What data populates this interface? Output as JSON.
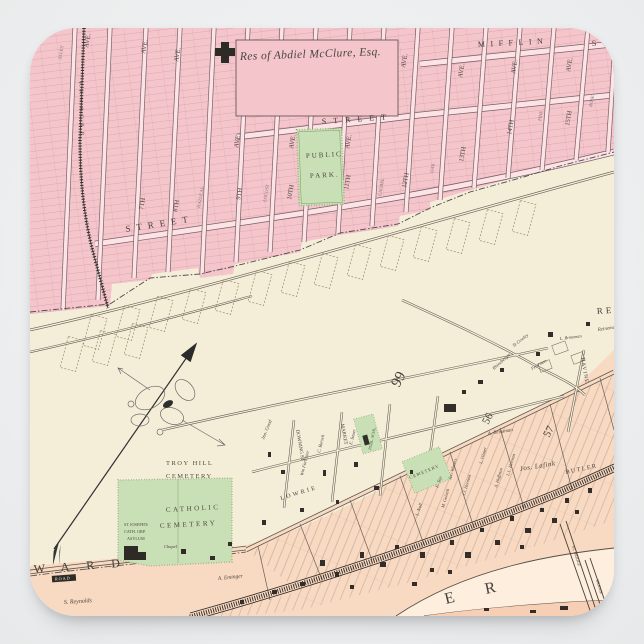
{
  "colors": {
    "page_bg": "#edeff0",
    "pink": "#f4c6cc",
    "pink_street": "#fbe3e6",
    "cream": "#f4eed9",
    "peach": "#f8d9c2",
    "peach_deep": "#f6cfb4",
    "river": "#fdeede",
    "green": "#c9dfb5",
    "green_edge": "#85a06b",
    "ink": "#3f3b38"
  },
  "labels": {
    "estate": "Res of Abdiel McClure, Esq.",
    "mifflin": "MIFFLIN",
    "mifflin_s": "S",
    "street_upper": "STREET",
    "street_lower": "STREET",
    "ward": "WARD",
    "road": "ROAD",
    "river_e": "E",
    "river_r": "R",
    "lowrie": "LOWRIE",
    "butler": "BUTLER",
    "ravine": "RAVINE",
    "downing": "DOWNING ST",
    "market": "MARKET",
    "re": "RE",
    "num99": "99",
    "num56": "56",
    "num57": "57",
    "railroad": "P. F. W. & C. R. R.",
    "ave": "AVE.",
    "seventh": "7TH",
    "eighth": "8TH",
    "ninth": "9TH",
    "tenth": "10TH",
    "eleventh": "11TH",
    "twelfth": "12TH",
    "thirteenth": "13TH",
    "fourteenth": "14TH",
    "fifteenth": "15TH",
    "locust": "LOCUST",
    "laurel": "LAUREL",
    "oak": "OAK",
    "pine": "PINE",
    "rose": "ROSE",
    "hazle": "HAZLE AL.",
    "alley": "ALLEY",
    "public1": "PUBLIC",
    "public2": "PARK.",
    "troy1": "TROY HILL",
    "troy2": "CEMETERY",
    "cath1": "CATHOLIC",
    "cath2": "CEMETERY",
    "asylum1": "ST JOSEPH'S",
    "asylum2": "CATH. ORP.",
    "asylum3": "ASYLUM",
    "chapel": "Chapel",
    "publ_schl": "PUBL. SCHL.",
    "cem_small": "CEMETERY",
    "jno_good": "Jno. Good",
    "forrester": "Wm Forrester",
    "borsch": "C. Borsch",
    "sauer": "E. Sauer",
    "eminger": "A. Eminger",
    "reynolds": "S. Reynolds",
    "lafink": "Jos. Lafink",
    "reinsman": "A. Reinsman",
    "brineman": "L. Brineman",
    "reineman": "Reineman",
    "cowley": "St Cowley",
    "rhineberger": "Rhineberger",
    "toy": "E. Toy",
    "noll": "L. Noll",
    "vilsner": "L. Vilsner",
    "hoffman": "A. Hoffman",
    "herman": "J.J. Herman",
    "herman2": "L.L. Herman",
    "winters": "Jac. Winters",
    "golseth": "M. Golseth",
    "peterman": "Peterman",
    "bridge1": "ST. BRIDGE",
    "bridge2": "BRIDGE"
  }
}
